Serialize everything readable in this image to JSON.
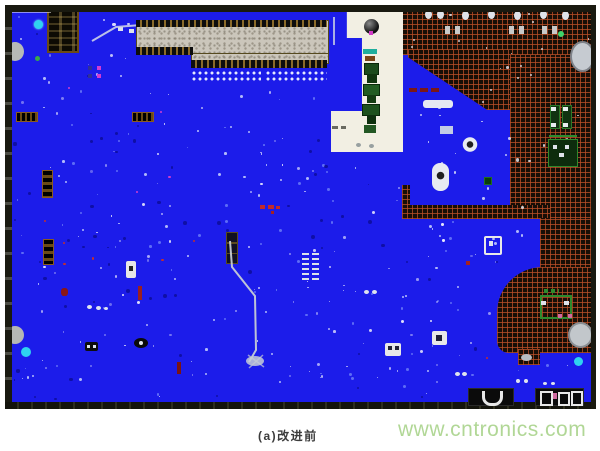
{
  "figure": {
    "caption": "(a)改进前",
    "watermark": "www.cntronics.com",
    "description": "PCB copper-plane layout screenshot, bottom view, before improvement"
  },
  "board": {
    "label": "pcb-layout-before-improvement",
    "colors": {
      "page_bg": "#ffffff",
      "plane_blue": "#1c1cea",
      "hatch_bg": "#170e06",
      "hatch_line": "#8a3a20",
      "border_dark": "#191910",
      "cutout_cream": "#f2efe3",
      "connector_gray": "#cbc6bb",
      "pin_black": "#0d0d0d",
      "pin_gold": "#8a6a2a",
      "pad_white": "#e9ecf2",
      "copper_green": "#2e8b2e",
      "cyan_via": "#2fd2f0",
      "caption_color": "#3c3c3c",
      "watermark_color": "#abd48e"
    }
  },
  "noise": {
    "seed": 7,
    "field_dots": 235,
    "dark_dots": 60,
    "island_dots": 16,
    "hatch_dots": 20,
    "red_dots": 7,
    "magenta_dots": 4
  }
}
